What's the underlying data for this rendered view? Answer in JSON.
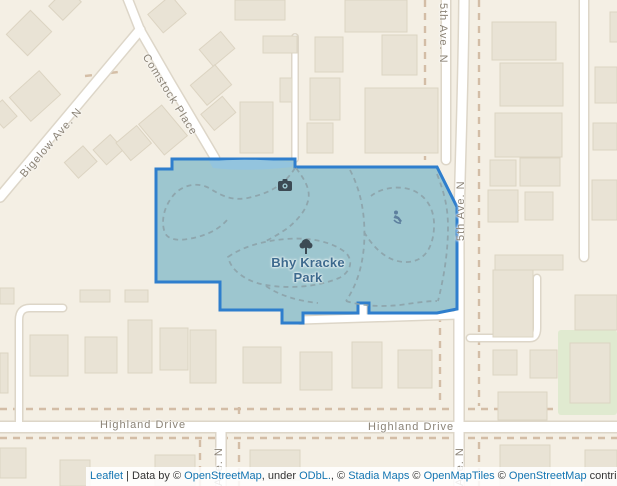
{
  "labels": {
    "park_name": "Bhy Kracke Park",
    "comstock": "Comstock Place",
    "bigelow": "Bigelow Ave. N",
    "fifth_top": "5th Ave. N",
    "fifth_mid": "5th Ave. N",
    "fifth_bottom": "Ave. N",
    "west_ave": "Ave. N",
    "highland_left": "Highland Drive",
    "highland_right": "Highland Drive"
  },
  "icons": {
    "camera": "camera-icon",
    "tree": "tree-icon",
    "amenity": "park-amenity-icon"
  },
  "colors": {
    "background": "#f4efe4",
    "building": "#e9e3d5",
    "building_border": "#dcd4c2",
    "road": "#ffffff",
    "road_casing": "#ddd6c8",
    "dashed_property_line": "#c9ad92",
    "park_fill": "#9dc6cf",
    "park_border": "#2e7ecd",
    "pond_water": "#93c4de",
    "trail": "#8da3aa",
    "grass": "#e0ead0",
    "street_label": "#8b8376",
    "park_label": "#3d6a8e",
    "link": "#1375b2"
  },
  "attribution": {
    "leaflet": "Leaflet",
    "data_by": " | Data by © ",
    "osm1": "OpenStreetMap",
    "under": ", under ",
    "odbl": "ODbL.",
    "comma_c": ", © ",
    "stadia": "Stadia Maps",
    "c1": " © ",
    "omt": "OpenMapTiles",
    "c2": " © ",
    "osm2": "OpenStreetMap",
    "contributors": " contributors"
  }
}
